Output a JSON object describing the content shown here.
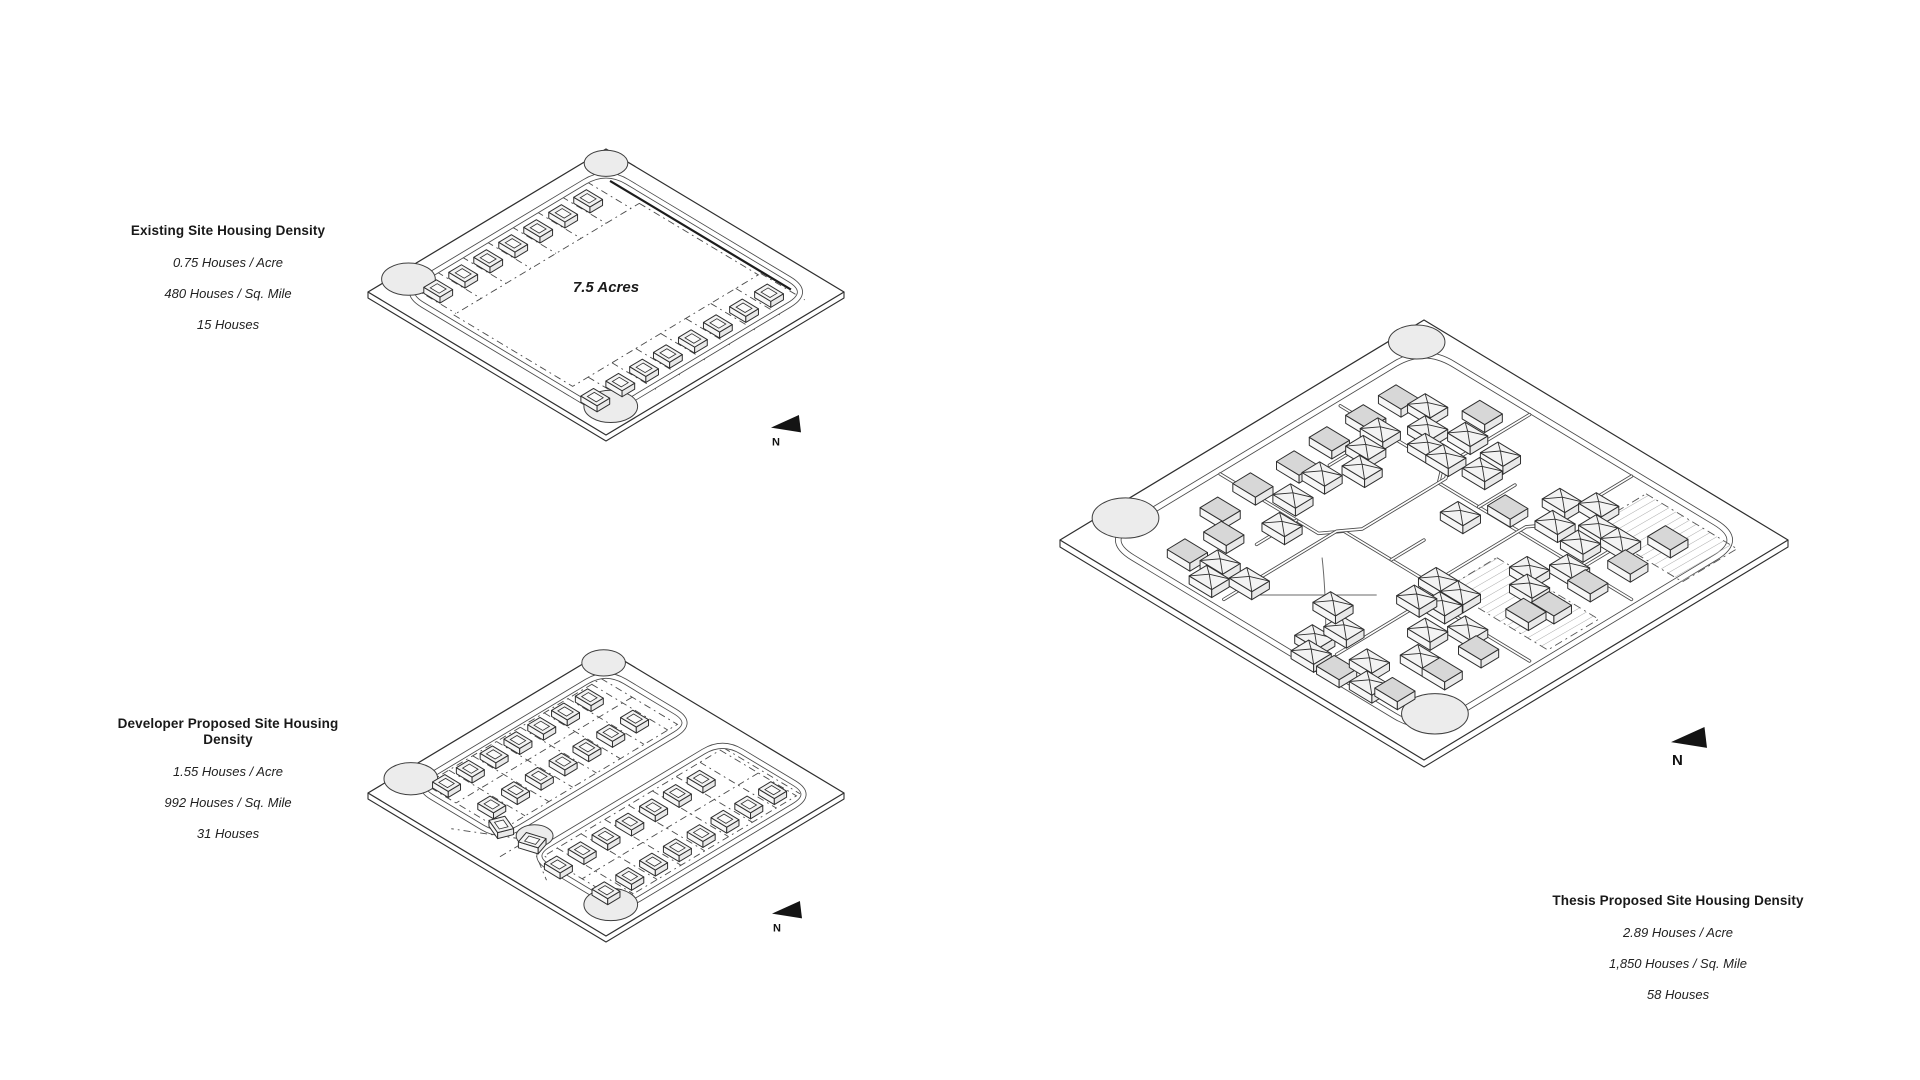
{
  "page": {
    "background": "#ffffff"
  },
  "panels": [
    {
      "id": "existing",
      "title": "Existing Site Housing Density",
      "stats": [
        "0.75 Houses / Acre",
        "480 Houses / Sq. Mile",
        "15 Houses"
      ],
      "area_label": "7.5 Acres",
      "north_label": "N",
      "house_count": 15
    },
    {
      "id": "developer",
      "title": "Developer Proposed Site Housing Density",
      "stats": [
        "1.55 Houses / Acre",
        "992 Houses / Sq. Mile",
        "31 Houses"
      ],
      "area_label": "",
      "north_label": "N",
      "house_count": 31
    },
    {
      "id": "thesis",
      "title": "Thesis Proposed Site Housing Density",
      "stats": [
        "2.89 Houses / Acre",
        "1,850 Houses / Sq. Mile",
        "58 Houses"
      ],
      "area_label": "",
      "north_label": "N",
      "house_count": 58
    }
  ],
  "diagram": {
    "colors": {
      "ink": "#2f2f2f",
      "roadInk": "#4a4a4a",
      "dashInk": "#4a4a4a",
      "pondFill": "#ececec",
      "houseTop": "#f3f3f3",
      "houseShade": "#d7d7d7",
      "sideL": "#f7f7f7",
      "sideR": "#e9e9e9",
      "hatchLine": "#ababab",
      "arrowFill": "#141414"
    },
    "sites": [
      {
        "id": "existing",
        "geom": {
          "cx": 606,
          "cy": 292,
          "halfW": 238,
          "halfH": 143
        },
        "plateDepth": 6,
        "roadW": 6,
        "hw": 3.4,
        "hz": 6,
        "ridge": 3,
        "accent": [
          12,
          10.3,
          88,
          10.3
        ],
        "loop": {
          "d": 7,
          "r": 9
        },
        "ponds": [
          {
            "u": 4,
            "v": 87,
            "r": 8
          },
          {
            "u": 5,
            "v": 5,
            "r": 6.5
          },
          {
            "u": 91,
            "v": 89,
            "r": 8
          }
        ],
        "dashRects": [
          [
            26,
            12,
            76,
            90
          ]
        ],
        "dashLines": [
          [
            7.5,
            15.5,
            26,
            15.5
          ],
          [
            7.5,
            26,
            26,
            26
          ],
          [
            7.5,
            36.5,
            26,
            36.5
          ],
          [
            7.5,
            47,
            26,
            47
          ],
          [
            7.5,
            57.5,
            26,
            57.5
          ],
          [
            7.5,
            68,
            26,
            68
          ],
          [
            7.5,
            78.5,
            26,
            78.5
          ],
          [
            7.5,
            89,
            26,
            89
          ],
          [
            76,
            11,
            94.5,
            11
          ],
          [
            76,
            21.5,
            94.5,
            21.5
          ],
          [
            76,
            32,
            94.5,
            32
          ],
          [
            76,
            42.5,
            94.5,
            42.5
          ],
          [
            76,
            53,
            94.5,
            53
          ],
          [
            76,
            63.5,
            94.5,
            63.5
          ],
          [
            76,
            73.5,
            94.5,
            73.5
          ],
          [
            76,
            83.5,
            94.5,
            83.5
          ],
          [
            76,
            94,
            94.5,
            94
          ]
        ],
        "streets": [],
        "paths": [],
        "pads": [],
        "houses": [
          [
            13.5,
            21,
            0
          ],
          [
            13.5,
            31.5,
            0
          ],
          [
            13.5,
            42,
            0
          ],
          [
            13.5,
            52.5,
            0
          ],
          [
            13.5,
            63,
            0
          ],
          [
            13.5,
            73.5,
            0
          ],
          [
            13.5,
            84,
            0
          ],
          [
            84.5,
            16,
            0
          ],
          [
            84.5,
            26.5,
            0
          ],
          [
            84.5,
            37.5,
            0
          ],
          [
            84.5,
            48,
            0
          ],
          [
            84.5,
            58.5,
            0
          ],
          [
            84.5,
            68.5,
            0
          ],
          [
            84.5,
            78.5,
            0
          ],
          [
            84.5,
            89,
            0
          ]
        ],
        "north": {
          "x": 771,
          "y": 415,
          "k": 30,
          "f": 11
        },
        "area_at": [
          50,
          50
        ],
        "area_size": 15
      },
      {
        "id": "developer",
        "geom": {
          "cx": 606,
          "cy": 793,
          "halfW": 238,
          "halfH": 143
        },
        "plateDepth": 6,
        "roadW": 6,
        "hw": 3.3,
        "hz": 6,
        "ridge": 3,
        "rects": [
          [
            7,
            7,
            44,
            88,
            8
          ],
          [
            56,
            7,
            94,
            88,
            8
          ]
        ],
        "culdesacs": [
          {
            "u": 50,
            "v": 80,
            "r": 5.5
          }
        ],
        "ponds": [
          {
            "u": 4,
            "v": 86,
            "r": 8
          },
          {
            "u": 4,
            "v": 5,
            "r": 6.5
          },
          {
            "u": 90,
            "v": 88,
            "r": 8
          }
        ],
        "dashRects": [
          [
            9,
            11,
            41,
            85
          ],
          [
            59,
            11,
            91,
            85
          ]
        ],
        "dashLines": [
          [
            22,
            11,
            22,
            85
          ],
          [
            75,
            11,
            75,
            85
          ],
          [
            9,
            15,
            41,
            15
          ],
          [
            9,
            25,
            41,
            25
          ],
          [
            9,
            35,
            41,
            35
          ],
          [
            9,
            45,
            41,
            45
          ],
          [
            9,
            55,
            41,
            55
          ],
          [
            9,
            65,
            41,
            65
          ],
          [
            9,
            75,
            41,
            75
          ],
          [
            59,
            9.5,
            91,
            9.5
          ],
          [
            59,
            19.5,
            91,
            19.5
          ],
          [
            59,
            29.5,
            91,
            29.5
          ],
          [
            59,
            39.5,
            91,
            39.5
          ],
          [
            59,
            49.5,
            91,
            49.5
          ],
          [
            59,
            59.5,
            91,
            59.5
          ],
          [
            59,
            69.5,
            91,
            69.5
          ],
          [
            59,
            79.5,
            91,
            79.5
          ],
          [
            48,
            84,
            30,
            95
          ],
          [
            50,
            86,
            50,
            96
          ],
          [
            53,
            84,
            68,
            93
          ]
        ],
        "streets": [],
        "paths": [],
        "pads": [],
        "houses": [
          [
            13,
            20,
            0
          ],
          [
            13,
            30,
            0
          ],
          [
            13,
            40,
            0
          ],
          [
            13,
            50,
            0
          ],
          [
            13,
            60,
            0
          ],
          [
            13,
            70,
            0
          ],
          [
            13,
            80,
            0
          ],
          [
            30,
            18,
            0
          ],
          [
            30,
            28,
            0
          ],
          [
            30,
            38,
            0
          ],
          [
            30,
            48,
            0
          ],
          [
            30,
            58,
            0
          ],
          [
            30,
            68,
            0
          ],
          [
            30,
            78,
            0
          ],
          [
            65,
            25,
            0
          ],
          [
            65,
            35,
            0
          ],
          [
            65,
            45,
            0
          ],
          [
            65,
            55,
            0
          ],
          [
            65,
            65,
            0
          ],
          [
            65,
            75,
            0
          ],
          [
            65,
            85,
            0
          ],
          [
            84,
            14,
            0
          ],
          [
            84,
            24,
            0
          ],
          [
            84,
            34,
            0
          ],
          [
            84,
            44,
            0
          ],
          [
            84,
            54,
            0
          ],
          [
            84,
            64,
            0
          ],
          [
            84,
            74,
            0
          ],
          [
            84,
            84,
            0
          ],
          [
            39,
            83,
            0,
            22
          ],
          [
            51,
            82,
            0,
            -18
          ]
        ],
        "north": {
          "x": 772,
          "y": 901,
          "k": 30,
          "f": 11
        }
      },
      {
        "id": "thesis",
        "geom": {
          "cx": 1424,
          "cy": 540,
          "halfW": 364,
          "halfH": 220
        },
        "plateDepth": 7,
        "roadW": 6.5,
        "hw": 3.1,
        "hz": 8,
        "ridge": 3.2,
        "loop": {
          "d": 6,
          "r": 8
        },
        "ponds": [
          {
            "u": 4,
            "v": 86,
            "r": 6.5
          },
          {
            "u": 4,
            "v": 6,
            "r": 5.5
          },
          {
            "u": 91,
            "v": 88,
            "r": 6.5
          }
        ],
        "dashRects": [],
        "dashLines": [],
        "pads": [
          [
            70,
            9,
            95,
            24
          ],
          [
            64,
            44,
            92,
            58
          ]
        ],
        "streets": [
          [
            [
              8,
              31
            ],
            [
              36,
              31
            ],
            [
              39,
              35
            ],
            [
              92,
              35
            ]
          ],
          [
            [
              7,
              63
            ],
            [
              34,
              63
            ],
            [
              37,
              59
            ],
            [
              59,
              59
            ],
            [
              62,
              63
            ],
            [
              92,
              63
            ]
          ],
          [
            [
              36,
              7
            ],
            [
              36,
              29
            ],
            [
              39,
              33
            ],
            [
              39,
              56
            ],
            [
              36,
              60
            ],
            [
              36,
              91
            ]
          ],
          [
            [
              64,
              7
            ],
            [
              64,
              29
            ],
            [
              61,
              33
            ],
            [
              61,
              56
            ],
            [
              64,
              60
            ],
            [
              64,
              88
            ]
          ],
          [
            [
              20,
              35
            ],
            [
              20,
              46
            ]
          ],
          [
            [
              50,
              35
            ],
            [
              50,
              25
            ]
          ],
          [
            [
              28,
              63
            ],
            [
              28,
              74
            ]
          ],
          [
            [
              78,
              35
            ],
            [
              78,
              27
            ]
          ],
          [
            [
              50,
              59
            ],
            [
              50,
              50
            ]
          ]
        ],
        "paths": [
          [
            [
              40,
              68
            ],
            [
              48,
              75
            ],
            [
              57,
              84
            ]
          ],
          [
            [
              56,
              69
            ],
            [
              48,
              77
            ],
            [
              39,
              86
            ]
          ]
        ],
        "houses": [
          [
            14,
            21,
            2
          ],
          [
            14,
            30,
            2
          ],
          [
            14,
            40,
            2
          ],
          [
            15,
            50,
            2
          ],
          [
            14,
            61,
            2
          ],
          [
            15,
            71,
            2
          ],
          [
            21,
            76,
            2
          ],
          [
            20,
            85,
            2
          ],
          [
            20,
            19,
            1
          ],
          [
            25,
            24,
            1
          ],
          [
            29,
            28,
            1
          ],
          [
            19,
            31,
            1
          ],
          [
            21,
            37,
            1
          ],
          [
            25,
            42,
            1
          ],
          [
            21,
            49,
            1
          ],
          [
            22,
            58,
            1
          ],
          [
            27,
            66,
            1
          ],
          [
            27,
            83,
            1
          ],
          [
            29,
            88,
            1
          ],
          [
            35,
            83,
            1
          ],
          [
            32,
            20,
            1
          ],
          [
            41,
            20,
            1
          ],
          [
            42,
            26,
            1
          ],
          [
            34,
            28,
            1
          ],
          [
            29,
            13,
            2
          ],
          [
            49,
            39,
            1
          ],
          [
            54,
            31,
            2
          ],
          [
            60,
            22,
            1
          ],
          [
            66,
            18,
            1
          ],
          [
            64,
            28,
            1
          ],
          [
            71,
            23,
            1
          ],
          [
            77,
            23,
            1
          ],
          [
            72,
            29,
            1
          ],
          [
            76,
            36,
            1
          ],
          [
            71,
            42,
            1
          ],
          [
            75,
            46,
            1
          ],
          [
            82,
            37,
            2
          ],
          [
            83,
            27,
            2
          ],
          [
            82,
            47,
            2
          ],
          [
            83,
            16,
            2
          ],
          [
            61,
            57,
            1
          ],
          [
            67,
            57,
            1
          ],
          [
            67,
            62,
            1
          ],
          [
            62,
            64,
            1
          ],
          [
            76,
            64,
            1
          ],
          [
            82,
            67,
            2
          ],
          [
            71,
            70,
            1
          ],
          [
            76,
            77,
            1
          ],
          [
            82,
            77,
            2
          ],
          [
            80,
            52,
            2
          ],
          [
            57,
            87,
            1
          ],
          [
            59,
            81,
            1
          ],
          [
            60,
            91,
            1
          ],
          [
            67,
            91,
            2
          ],
          [
            70,
            85,
            1
          ],
          [
            75,
            90,
            1
          ],
          [
            80,
            88,
            2
          ],
          [
            52,
            77,
            1
          ]
        ],
        "north": {
          "x": 1671,
          "y": 727,
          "k": 36,
          "f": 15
        }
      }
    ]
  }
}
